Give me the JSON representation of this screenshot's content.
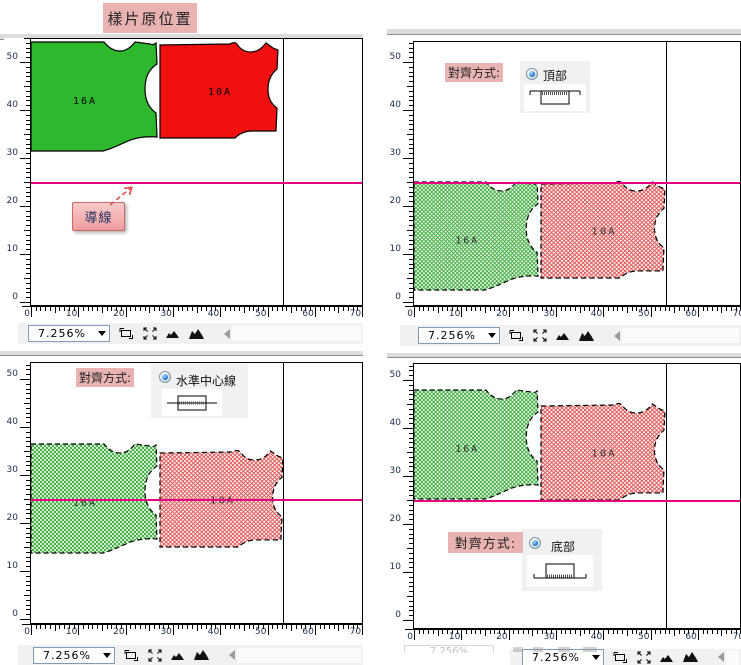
{
  "app": {
    "type": "pattern-cad-alignment-demo"
  },
  "palette": {
    "solid_green": "#2eb82e",
    "solid_red": "#f01010",
    "hatch_green": "#3fae3f",
    "hatch_red": "#e25555",
    "guide_line": "#e6007e",
    "label_pink": "#e9b3b3",
    "status_bg": "#f1f1f1",
    "ruler_text": "#1c2e4a"
  },
  "quadrants": [
    {
      "id": "q0",
      "title": "樣片原位置",
      "guide_tag": "導線",
      "status": {
        "zoom": "7.256%"
      },
      "ruler_v": [
        50,
        40,
        30,
        20,
        10,
        0
      ],
      "ruler_h": [
        0,
        10,
        20,
        30,
        40,
        50,
        60,
        70
      ],
      "guide_y_units": 25,
      "vline_x_units": 53.3,
      "pieces": [
        {
          "label": "16A",
          "shape": "left",
          "variant": "solid",
          "color": "green",
          "x": 0,
          "y": 3,
          "w": 129,
          "h": 110
        },
        {
          "label": "10A",
          "shape": "right",
          "variant": "solid",
          "color": "red",
          "x": 129,
          "y": 4,
          "w": 118,
          "h": 95
        }
      ]
    },
    {
      "id": "q1",
      "align": {
        "label": "對齊方式:",
        "option": "頂部",
        "glyph": "top"
      },
      "status": {
        "zoom": "7.256%"
      },
      "ruler_v": [
        50,
        40,
        30,
        20,
        10,
        0
      ],
      "ruler_h": [
        0,
        10,
        20,
        30,
        40,
        50,
        60,
        70
      ],
      "guide_y_units": 25,
      "vline_x_units": 53.3,
      "pieces": [
        {
          "label": "16A",
          "shape": "left",
          "variant": "hatch",
          "color": "green",
          "x": 0,
          "y": 140,
          "w": 127,
          "h": 109
        },
        {
          "label": "10A",
          "shape": "right",
          "variant": "hatch",
          "color": "red",
          "x": 127,
          "y": 140,
          "w": 124,
          "h": 96
        }
      ]
    },
    {
      "id": "q2",
      "align": {
        "label": "對齊方式:",
        "option": "水準中心線",
        "glyph": "hcenter"
      },
      "status": {
        "zoom": "7.256%"
      },
      "ruler_v": [
        50,
        40,
        30,
        20,
        10,
        0
      ],
      "ruler_h": [
        0,
        10,
        20,
        30,
        40,
        50,
        60,
        70
      ],
      "guide_y_units": 25,
      "vline_x_units": 53.3,
      "pieces": [
        {
          "label": "16A",
          "shape": "left",
          "variant": "hatch",
          "color": "green",
          "x": 0,
          "y": 81,
          "w": 129,
          "h": 110
        },
        {
          "label": "10A",
          "shape": "right",
          "variant": "hatch",
          "color": "red",
          "x": 129,
          "y": 88,
          "w": 123,
          "h": 96
        }
      ]
    },
    {
      "id": "q3",
      "align": {
        "label": "對齊方式:",
        "option": "底部",
        "glyph": "bottom"
      },
      "status": {
        "zoom": "7.256%"
      },
      "ruler_v": [
        50,
        40,
        30,
        20,
        10,
        0
      ],
      "ruler_h": [
        0,
        10,
        20,
        30,
        40,
        50,
        60,
        70
      ],
      "guide_y_units": 25,
      "vline_x_units": 53.3,
      "pieces": [
        {
          "label": "16A",
          "shape": "left",
          "variant": "hatch",
          "color": "green",
          "x": 0,
          "y": 26,
          "w": 127,
          "h": 110
        },
        {
          "label": "10A",
          "shape": "right",
          "variant": "hatch",
          "color": "red",
          "x": 127,
          "y": 40,
          "w": 124,
          "h": 96
        }
      ]
    }
  ],
  "remnant_status": {
    "zoom": "7.256%"
  }
}
